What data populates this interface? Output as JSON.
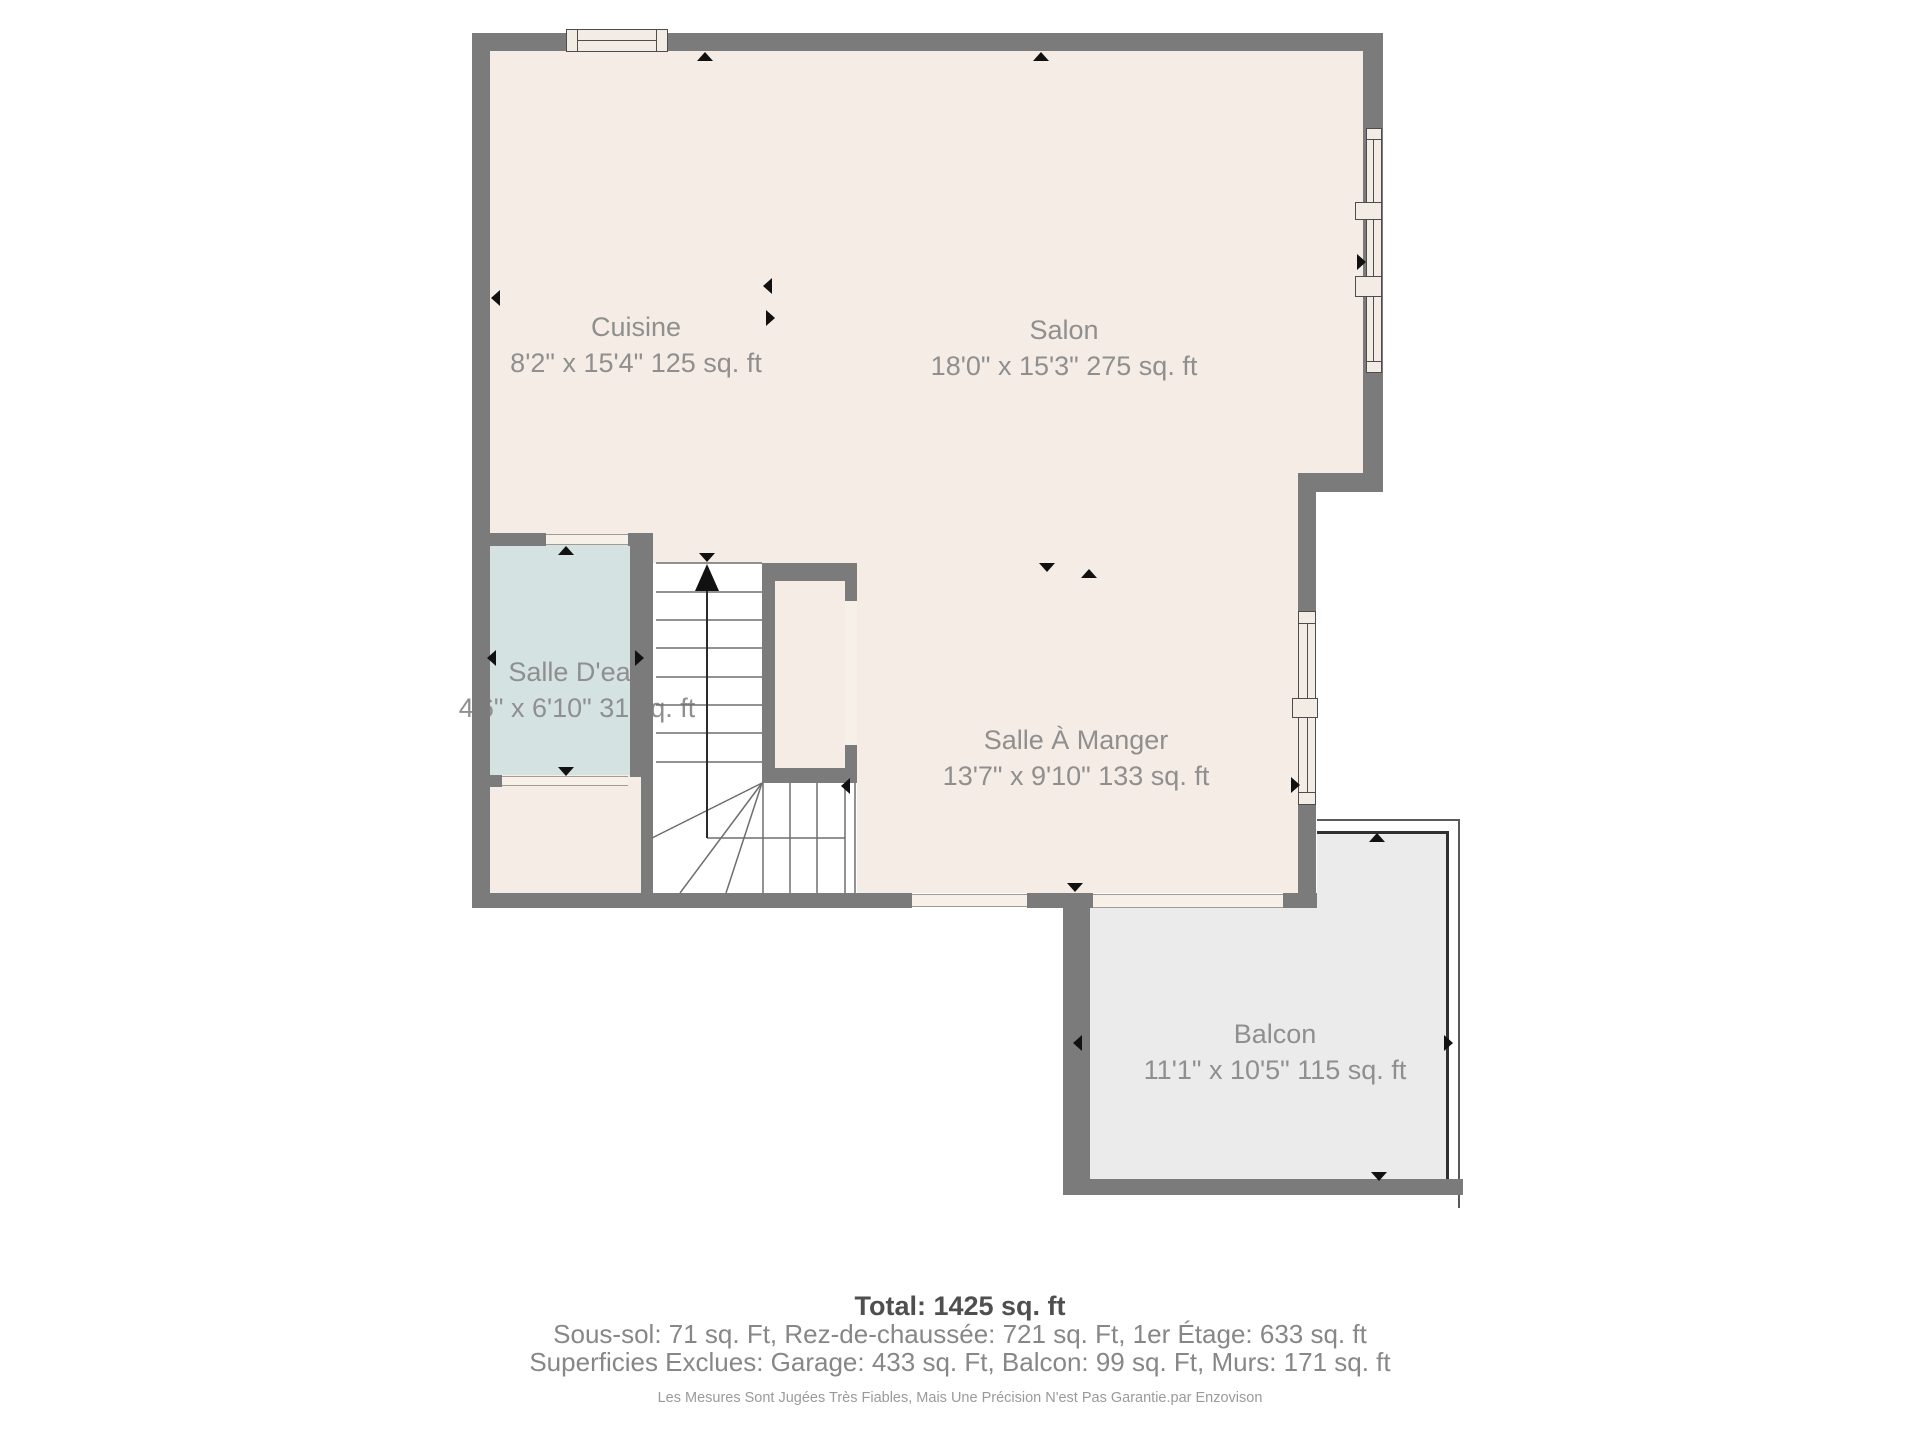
{
  "plan": {
    "type": "floor-plan",
    "colors": {
      "wall": "#7b7b7b",
      "floor": "#f5ece5",
      "bathroom_floor": "#d5e2e2",
      "balcony_floor": "#ebebeb",
      "label_text": "#8f8f8f",
      "arrow": "#111111"
    },
    "rooms": [
      {
        "id": "cuisine",
        "name": "Cuisine",
        "dims": "8'2\" x 15'4\" 125 sq. ft"
      },
      {
        "id": "salon",
        "name": "Salon",
        "dims": "18'0\" x 15'3\" 275 sq. ft"
      },
      {
        "id": "salle-deau",
        "name": "Salle D'eau",
        "dims": "4'6\" x 6'10\" 31 sq. ft"
      },
      {
        "id": "salle-a-manger",
        "name": "Salle À Manger",
        "dims": "13'7\" x 9'10\" 133 sq. ft"
      },
      {
        "id": "balcon",
        "name": "Balcon",
        "dims": "11'1\" x 10'5\" 115 sq. ft"
      }
    ],
    "summary": {
      "total": "Total: 1425 sq. ft",
      "floors_line": "Sous-sol: 71 sq. Ft, Rez-de-chaussée: 721 sq. Ft, 1er Étage: 633 sq. ft",
      "excluded_line": "Superficies Exclues: Garage: 433 sq. Ft, Balcon: 99 sq. Ft, Murs: 171 sq. ft",
      "disclaimer": "Les Mesures Sont Jugées Très Fiables, Mais Une Précision N'est Pas Garantie.par Enzovison"
    }
  }
}
